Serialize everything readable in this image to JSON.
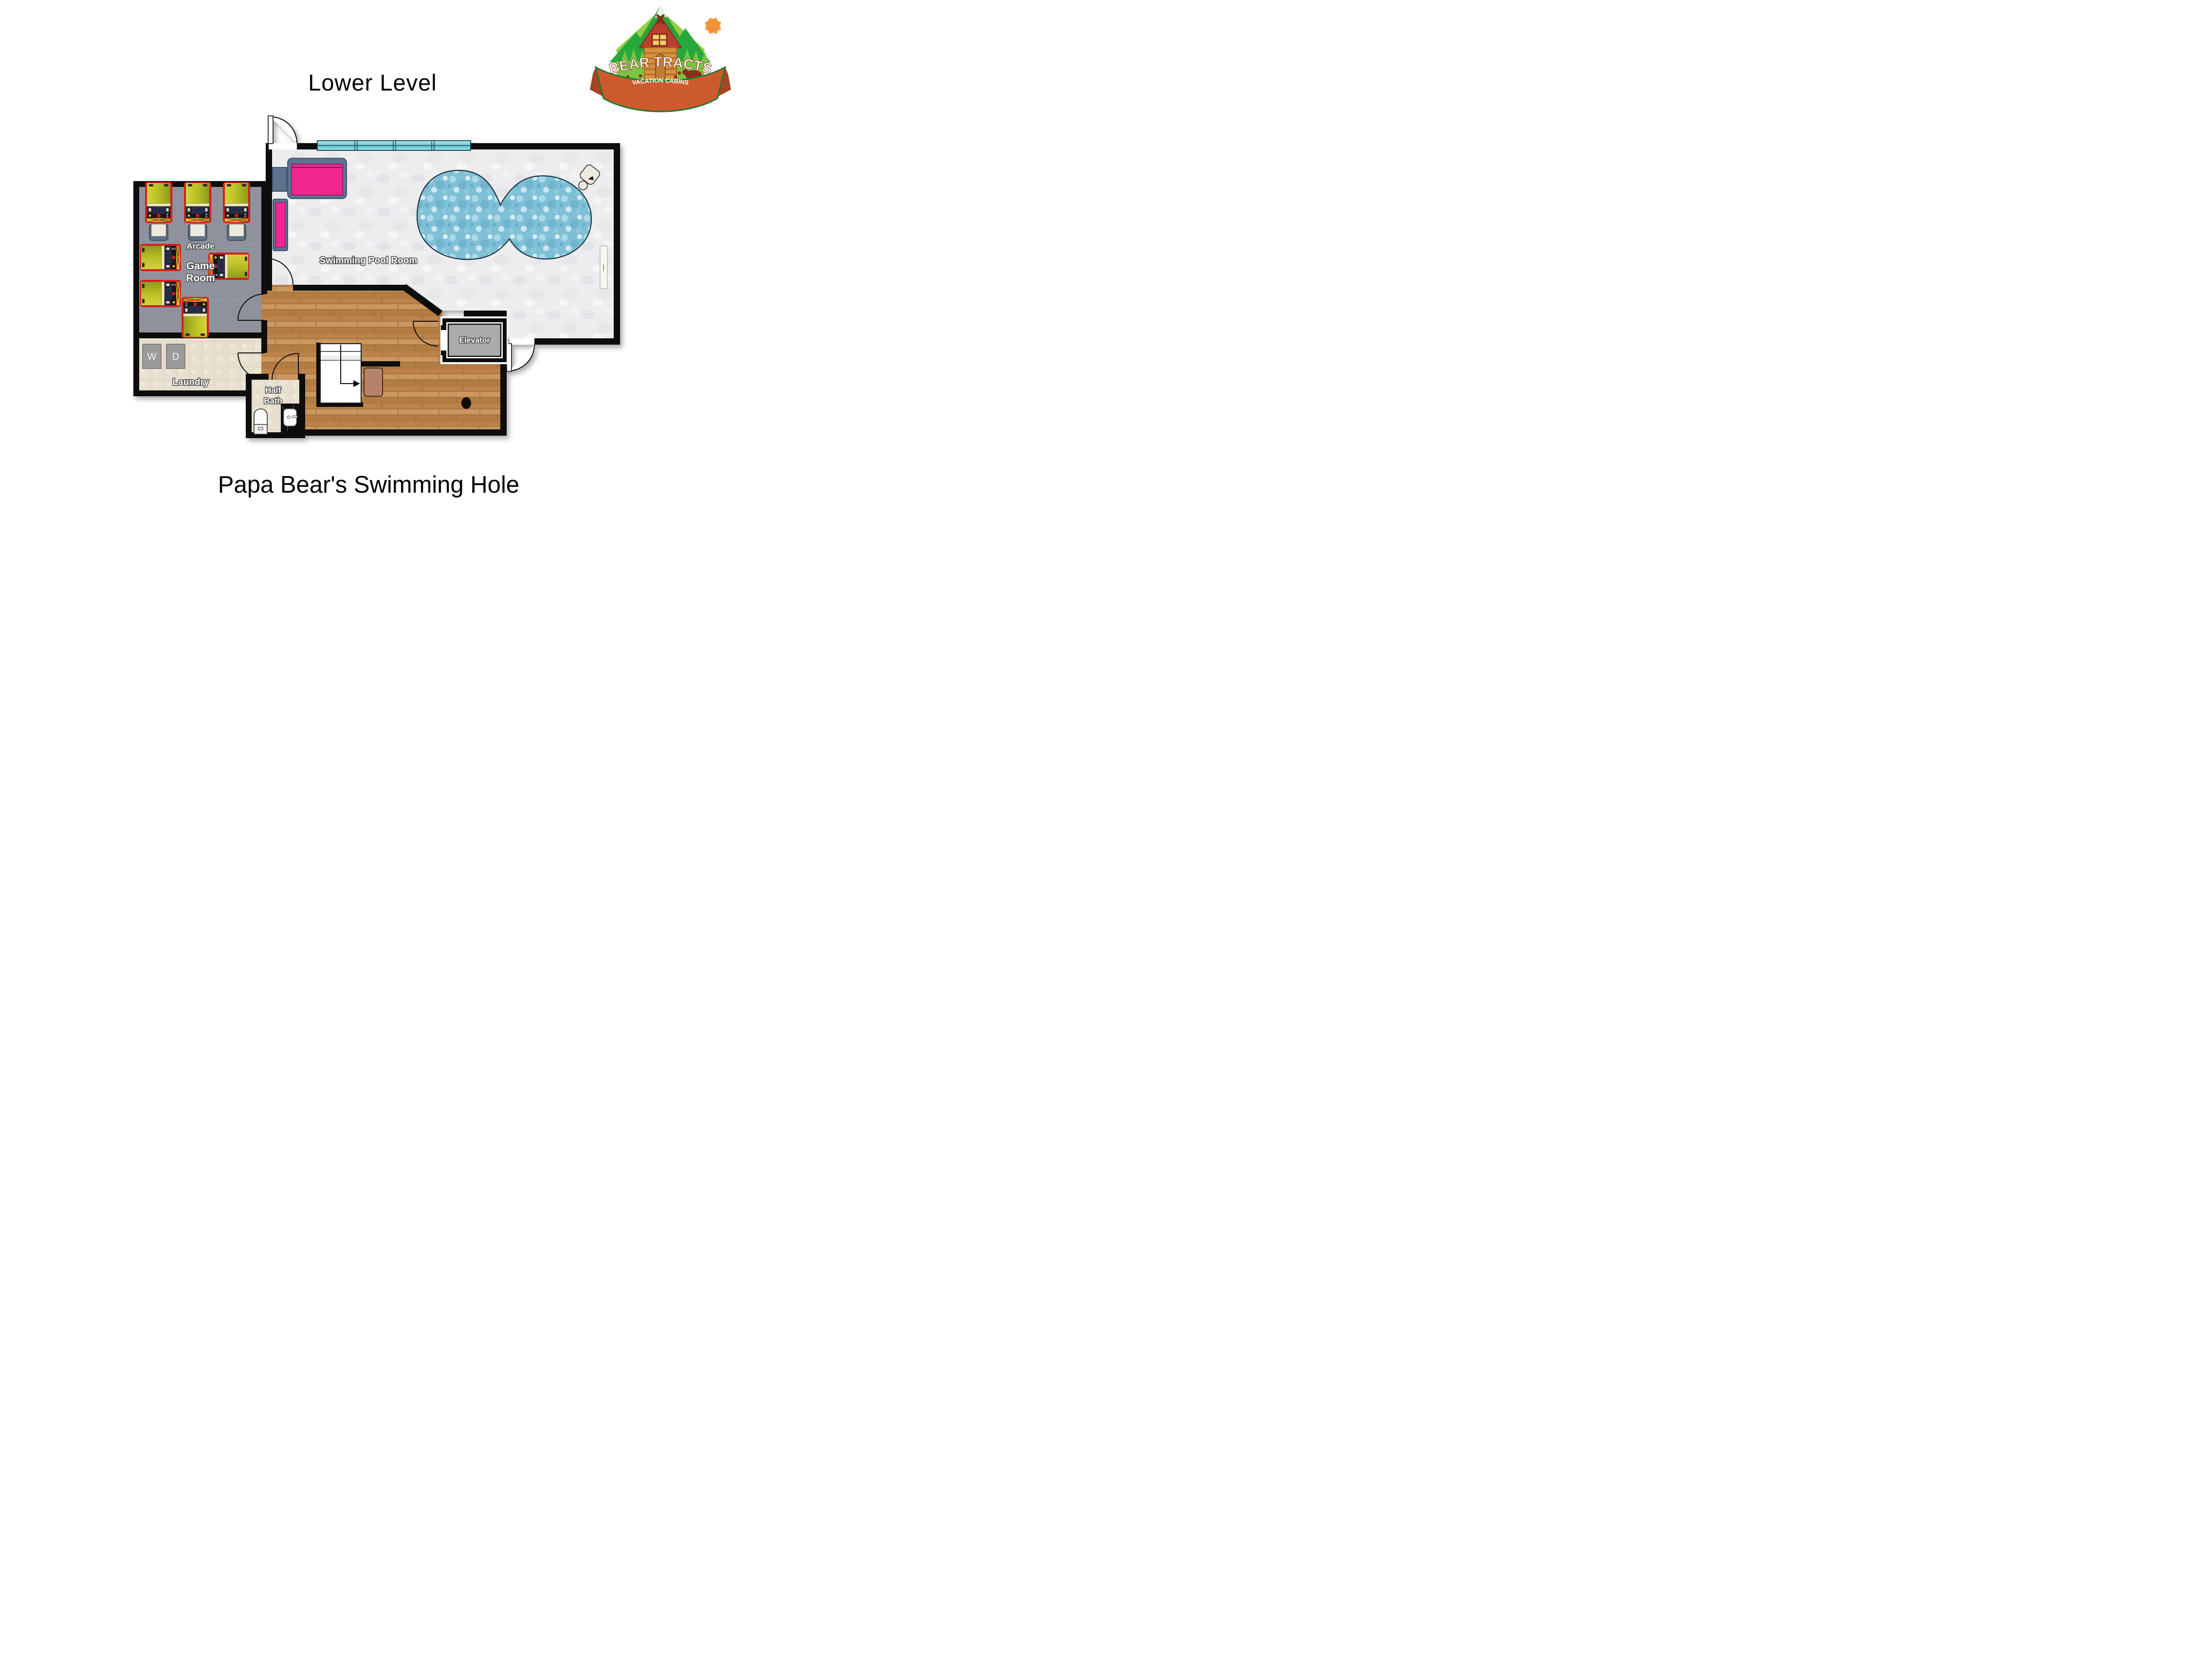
{
  "header": {
    "title": "Lower Level"
  },
  "footer": {
    "title": "Papa Bear's Swimming Hole"
  },
  "logo": {
    "name": "BEAR TRACTS",
    "tagline": "VACATION CABINS"
  },
  "plan": {
    "rooms": {
      "arcade_label": "Arcade",
      "game_room_line1": "Game",
      "game_room_line2": "Room",
      "pool_room": "Swimming Pool Room",
      "laundry": "Laundry",
      "half_bath_line1": "Half",
      "half_bath_line2": "Bath",
      "elevator": "Elevator",
      "washer": "W",
      "dryer": "D"
    },
    "colors": {
      "wall": "#101010",
      "carpet": "#8f919d",
      "wood": "#c28a52",
      "tile": "#e7e0cf",
      "pool_floor": "#ededef",
      "water": "#7fc0d6",
      "window": "#8fd8e2",
      "accent_pink": "#f2278f",
      "frame_blue": "#5b7390",
      "elevator_gray": "#ababab",
      "mat_brown": "#b5826b",
      "arcade_red": "#d31f1f",
      "logo_green": "#2e9e3e",
      "logo_orange": "#cd5a2d"
    }
  }
}
